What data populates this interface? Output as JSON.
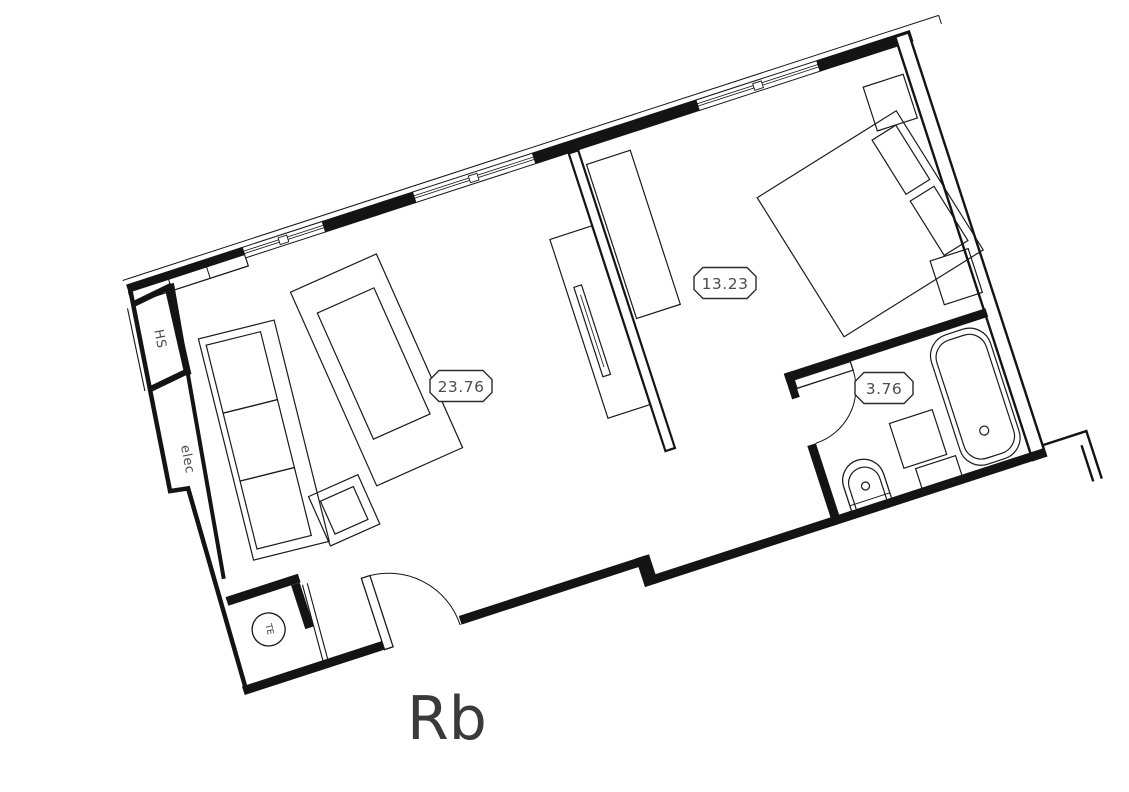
{
  "title": {
    "label": "Rb"
  },
  "rooms": [
    {
      "name": "living-room",
      "area_label": "23.76"
    },
    {
      "name": "bedroom",
      "area_label": "13.23"
    },
    {
      "name": "bathroom",
      "area_label": "3.76"
    }
  ],
  "annotations": {
    "hs": "HS",
    "elec": "elec",
    "te": "TE"
  },
  "colors": {
    "line": "#141414",
    "label_text": "#4d4d4d",
    "title_text": "#3a3a3a",
    "background": "#ffffff"
  }
}
